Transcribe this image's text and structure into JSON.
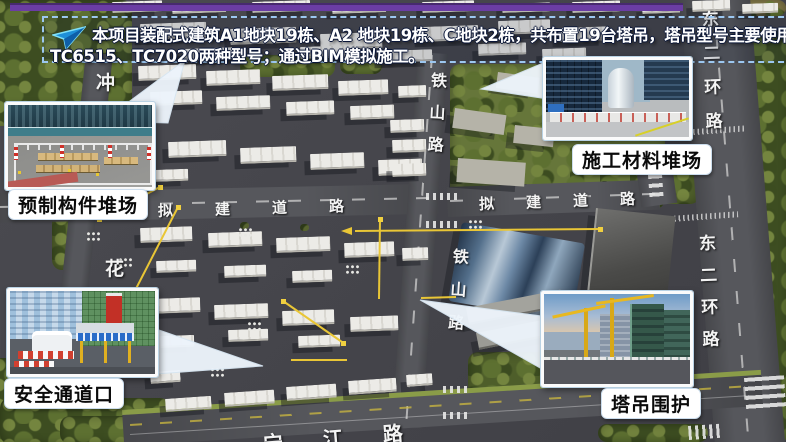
{
  "banner": {
    "line1": "本项目装配式建筑A1地块19栋、A2 地块19栋、C地块2栋，共布置19台塔吊，塔吊型号主要使用",
    "line2": "TC6515、TC7020两种型号；通过BIM模拟施工。",
    "icon": "paper-plane-arrow"
  },
  "callouts": {
    "prefab_yard": {
      "label": "预制构件堆场"
    },
    "material_yard": {
      "label": "施工材料堆场"
    },
    "safety_gate": {
      "label": "安全通道口"
    },
    "crane_enclosure": {
      "label": "塔吊围护"
    }
  },
  "roads": {
    "proposed_left": "拟建道路",
    "proposed_right": "拟建道路",
    "tieshan_upper": "铁山路",
    "tieshan_lower": "铁山路",
    "ring_upper": "东二环路",
    "ring_lower": "东二环路",
    "hua_char": "花",
    "chong_char": "冲",
    "riverside": "宁江路"
  },
  "colors": {
    "accent_bar": "#6b3da4",
    "banner_border": "#9cc7f0",
    "crane_yellow": "#e9c636",
    "label_bg": "#ffffff",
    "label_text": "#111111"
  }
}
